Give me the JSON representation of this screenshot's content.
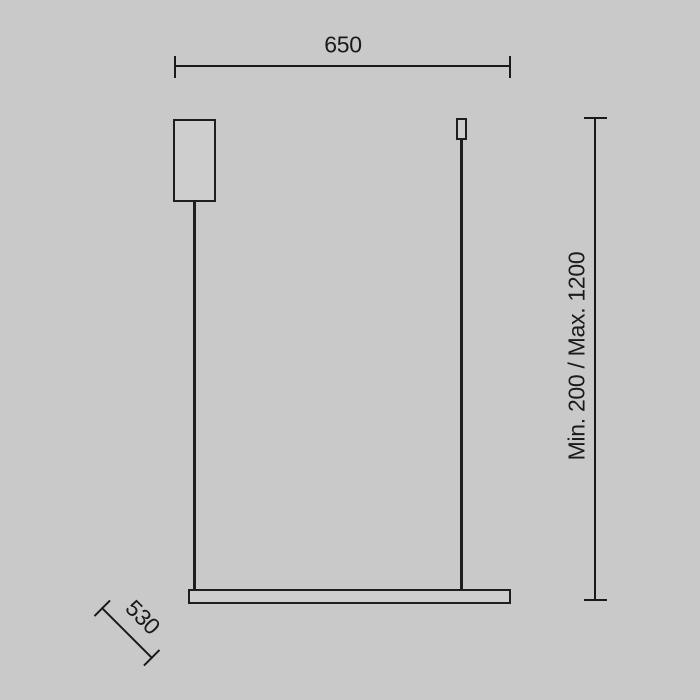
{
  "drawing": {
    "type": "pendant-lamp-dimension-diagram",
    "background_color": "#c9c9c9",
    "line_color": "#1a1a1a",
    "dimensions": {
      "width_label": "650",
      "height_label": "Min. 200 / Max. 1200",
      "depth_label": "530"
    }
  }
}
